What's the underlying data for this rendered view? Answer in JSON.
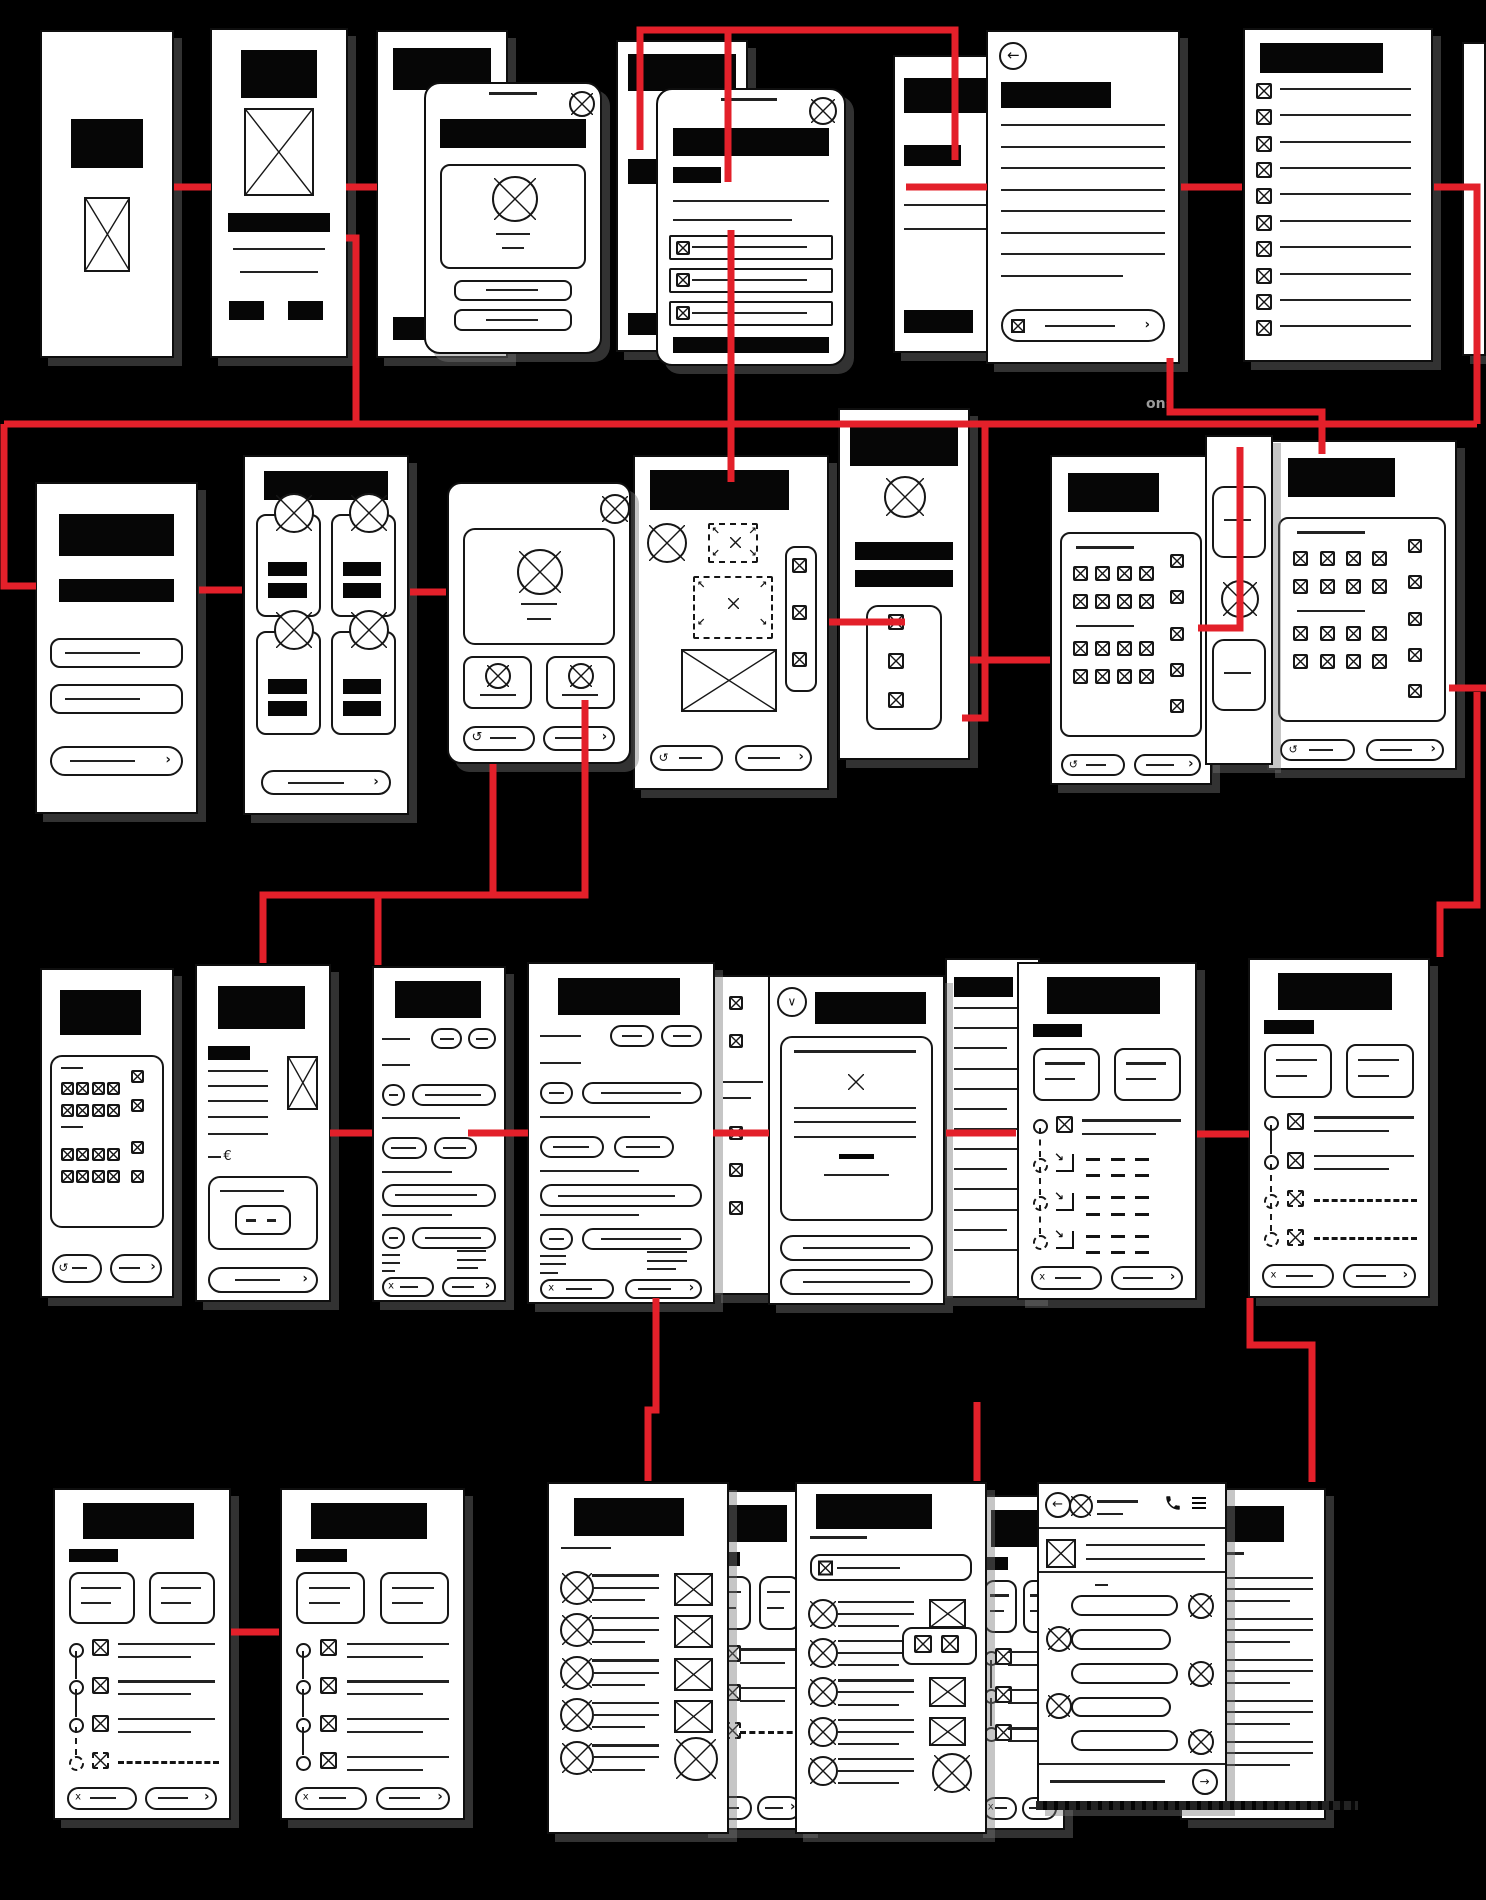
{
  "canvas": {
    "width": 1486,
    "height": 1900,
    "background": "#000000"
  },
  "palette": {
    "screen_bg": "#ffffff",
    "ink": "#161616",
    "black_fill": "#060606",
    "connector_red": "#e3202a",
    "shadow_gray": "rgba(118,118,118,0.42)"
  },
  "icons": {
    "back": "←",
    "send": "→",
    "chevron_right": "›",
    "chevron_down": "∨",
    "undo": "↺",
    "cancel_x": "x",
    "euro": "€",
    "redirect": "↘",
    "corner_arrows": [
      "↖",
      "↗",
      "↙",
      "↘"
    ]
  },
  "captions": [
    {
      "id": "caption-fragment-ons",
      "text": "ons",
      "x": 1146,
      "y": 396,
      "color": "#9b9b9b",
      "size": 14
    },
    {
      "id": "caption-illegible-chat",
      "text": "",
      "x": 1036,
      "y": 1801,
      "w": 322,
      "h": 9
    }
  ],
  "screens": [
    {
      "id": "splash",
      "name": "screen-splash",
      "kind": "hero",
      "x": 40,
      "y": 30,
      "w": 134,
      "h": 328,
      "z": 2
    },
    {
      "id": "onboarding",
      "name": "screen-onboarding",
      "kind": "onboard",
      "x": 210,
      "y": 28,
      "w": 138,
      "h": 330,
      "z": 2
    },
    {
      "id": "welcome-base",
      "name": "screen-welcome-base",
      "kind": "cover",
      "x": 376,
      "y": 30,
      "w": 132,
      "h": 328,
      "z": 2
    },
    {
      "id": "profile-modal",
      "name": "modal-profile-setup",
      "kind": "modalProfile",
      "x": 424,
      "y": 82,
      "w": 178,
      "h": 272,
      "z": 3,
      "r": 16
    },
    {
      "id": "content-base",
      "name": "screen-content-base",
      "kind": "cover2",
      "x": 616,
      "y": 40,
      "w": 132,
      "h": 312,
      "z": 2
    },
    {
      "id": "options-modal",
      "name": "modal-options-list",
      "kind": "modalList",
      "x": 656,
      "y": 88,
      "w": 190,
      "h": 278,
      "z": 4,
      "r": 16
    },
    {
      "id": "detail-underlay",
      "name": "screen-detail-underlay",
      "kind": "underlay",
      "x": 893,
      "y": 55,
      "w": 118,
      "h": 298,
      "z": 2
    },
    {
      "id": "article-back",
      "name": "screen-article-detail",
      "kind": "back",
      "x": 986,
      "y": 30,
      "w": 194,
      "h": 334,
      "z": 3
    },
    {
      "id": "checklist",
      "name": "screen-checklist",
      "kind": "checklist",
      "x": 1243,
      "y": 28,
      "w": 190,
      "h": 334,
      "z": 2
    },
    {
      "id": "edge-sliver",
      "name": "screen-edge-sliver",
      "kind": "sliver",
      "x": 1462,
      "y": 42,
      "w": 24,
      "h": 314,
      "z": 1
    },
    {
      "id": "login",
      "name": "screen-login",
      "kind": "login",
      "x": 35,
      "y": 482,
      "w": 163,
      "h": 332,
      "z": 2
    },
    {
      "id": "catalog",
      "name": "screen-catalog",
      "kind": "catalog",
      "x": 243,
      "y": 455,
      "w": 166,
      "h": 360,
      "z": 2
    },
    {
      "id": "item-modal",
      "name": "modal-item-preview",
      "kind": "itemModal",
      "x": 447,
      "y": 482,
      "w": 184,
      "h": 282,
      "z": 3,
      "r": 14
    },
    {
      "id": "upload",
      "name": "screen-upload",
      "kind": "upload",
      "x": 633,
      "y": 455,
      "w": 196,
      "h": 335,
      "z": 2
    },
    {
      "id": "profile-strip",
      "name": "screen-profile-strip",
      "kind": "stripNarrow",
      "x": 838,
      "y": 408,
      "w": 132,
      "h": 352,
      "z": 2
    },
    {
      "id": "icon-grid-a",
      "name": "screen-icon-grid-a",
      "kind": "iconGrid",
      "x": 1050,
      "y": 455,
      "w": 162,
      "h": 330,
      "z": 2
    },
    {
      "id": "mini-strip",
      "name": "screen-mini-strip",
      "kind": "miniStrip",
      "x": 1205,
      "y": 435,
      "w": 68,
      "h": 330,
      "z": 3
    },
    {
      "id": "icon-grid-b",
      "name": "screen-icon-grid-b",
      "kind": "iconGrid",
      "x": 1267,
      "y": 440,
      "w": 190,
      "h": 330,
      "z": 2
    },
    {
      "id": "grid-small",
      "name": "screen-icon-grid-small",
      "kind": "gridSmall",
      "x": 40,
      "y": 968,
      "w": 134,
      "h": 330,
      "z": 2
    },
    {
      "id": "invoice",
      "name": "screen-invoice",
      "kind": "invoice",
      "x": 195,
      "y": 964,
      "w": 136,
      "h": 338,
      "z": 2
    },
    {
      "id": "form-a",
      "name": "screen-form-a",
      "kind": "form",
      "x": 372,
      "y": 966,
      "w": 134,
      "h": 336,
      "z": 2
    },
    {
      "id": "form-b",
      "name": "screen-form-b",
      "kind": "form",
      "x": 527,
      "y": 962,
      "w": 188,
      "h": 342,
      "z": 3
    },
    {
      "id": "grid-sliver",
      "name": "screen-grid-sliver",
      "kind": "gridBehind",
      "x": 713,
      "y": 975,
      "w": 60,
      "h": 320,
      "z": 2
    },
    {
      "id": "confirm-card",
      "name": "screen-confirm-card",
      "kind": "confirm",
      "x": 768,
      "y": 975,
      "w": 177,
      "h": 330,
      "z": 3
    },
    {
      "id": "lines-sliver",
      "name": "screen-lines-sliver",
      "kind": "linesSliver",
      "x": 945,
      "y": 958,
      "w": 95,
      "h": 340,
      "z": 2
    },
    {
      "id": "stepper-a",
      "name": "screen-stepper-a",
      "kind": "stepper",
      "x": 1017,
      "y": 962,
      "w": 180,
      "h": 338,
      "z": 3,
      "rows": [
        "x",
        "arrow",
        "arrow",
        "arrow"
      ]
    },
    {
      "id": "stepper-b",
      "name": "screen-stepper-b",
      "kind": "stepper",
      "x": 1248,
      "y": 958,
      "w": 182,
      "h": 340,
      "z": 2,
      "rows": [
        "x",
        "x",
        "dashed",
        "dashed"
      ]
    },
    {
      "id": "stepper-c",
      "name": "screen-stepper-c",
      "kind": "stepper",
      "x": 53,
      "y": 1488,
      "w": 178,
      "h": 332,
      "z": 2,
      "rows": [
        "x",
        "x",
        "x",
        "dashed"
      ]
    },
    {
      "id": "stepper-d",
      "name": "screen-stepper-d",
      "kind": "stepper",
      "x": 280,
      "y": 1488,
      "w": 185,
      "h": 332,
      "z": 2,
      "rows": [
        "x",
        "x",
        "x",
        "x"
      ]
    },
    {
      "id": "contacts",
      "name": "screen-contacts-list",
      "kind": "contacts",
      "x": 547,
      "y": 1482,
      "w": 182,
      "h": 352,
      "z": 4
    },
    {
      "id": "stepper-e",
      "name": "screen-stepper-sliver-a",
      "kind": "stepper",
      "x": 700,
      "y": 1490,
      "w": 110,
      "h": 340,
      "z": 3,
      "rows": [
        "x",
        "x",
        "dashed"
      ]
    },
    {
      "id": "search",
      "name": "screen-search-results",
      "kind": "search",
      "x": 795,
      "y": 1482,
      "w": 192,
      "h": 352,
      "z": 4
    },
    {
      "id": "stepper-f",
      "name": "screen-stepper-sliver-b",
      "kind": "stepper",
      "x": 975,
      "y": 1495,
      "w": 90,
      "h": 335,
      "z": 3,
      "rows": [
        "x",
        "x",
        "x"
      ]
    },
    {
      "id": "chat",
      "name": "screen-chat",
      "kind": "chat",
      "x": 1037,
      "y": 1482,
      "w": 190,
      "h": 326,
      "z": 5
    },
    {
      "id": "feed",
      "name": "screen-feed",
      "kind": "feedBehind",
      "x": 1180,
      "y": 1488,
      "w": 146,
      "h": 332,
      "z": 4
    }
  ],
  "connectors": [
    {
      "id": "c1",
      "points": [
        [
          174,
          187
        ],
        [
          211,
          187
        ]
      ]
    },
    {
      "id": "c2",
      "points": [
        [
          346,
          187
        ],
        [
          377,
          187
        ]
      ]
    },
    {
      "id": "c3",
      "points": [
        [
          640,
          150
        ],
        [
          640,
          30
        ],
        [
          955,
          30
        ],
        [
          955,
          160
        ]
      ]
    },
    {
      "id": "c4",
      "points": [
        [
          728,
          30
        ],
        [
          728,
          182
        ]
      ]
    },
    {
      "id": "c5",
      "points": [
        [
          906,
          187
        ],
        [
          987,
          187
        ]
      ]
    },
    {
      "id": "c6",
      "points": [
        [
          1181,
          187
        ],
        [
          1242,
          187
        ]
      ]
    },
    {
      "id": "c7",
      "points": [
        [
          1434,
          187
        ],
        [
          1477,
          187
        ],
        [
          1477,
          424
        ]
      ]
    },
    {
      "id": "c8",
      "points": [
        [
          4,
          424
        ],
        [
          1477,
          424
        ]
      ]
    },
    {
      "id": "c9",
      "points": [
        [
          4,
          424
        ],
        [
          4,
          586
        ],
        [
          36,
          586
        ]
      ]
    },
    {
      "id": "c10",
      "points": [
        [
          346,
          238
        ],
        [
          356,
          238
        ],
        [
          356,
          424
        ]
      ]
    },
    {
      "id": "c11",
      "points": [
        [
          731,
          230
        ],
        [
          731,
          482
        ]
      ]
    },
    {
      "id": "c12",
      "points": [
        [
          1170,
          358
        ],
        [
          1170,
          412
        ],
        [
          1322,
          412
        ],
        [
          1322,
          454
        ]
      ]
    },
    {
      "id": "c13",
      "points": [
        [
          199,
          590
        ],
        [
          242,
          590
        ]
      ]
    },
    {
      "id": "c14",
      "points": [
        [
          410,
          592
        ],
        [
          446,
          592
        ]
      ]
    },
    {
      "id": "c15",
      "points": [
        [
          829,
          622
        ],
        [
          905,
          622
        ]
      ]
    },
    {
      "id": "c16",
      "points": [
        [
          985,
          424
        ],
        [
          985,
          718
        ],
        [
          962,
          718
        ]
      ]
    },
    {
      "id": "c17",
      "points": [
        [
          970,
          660
        ],
        [
          1050,
          660
        ]
      ]
    },
    {
      "id": "c18",
      "points": [
        [
          1240,
          447
        ],
        [
          1240,
          628
        ],
        [
          1198,
          628
        ]
      ]
    },
    {
      "id": "c19",
      "points": [
        [
          1449,
          688
        ],
        [
          1486,
          688
        ]
      ]
    },
    {
      "id": "c20",
      "points": [
        [
          585,
          700
        ],
        [
          585,
          895
        ],
        [
          263,
          895
        ],
        [
          263,
          963
        ]
      ]
    },
    {
      "id": "c21",
      "points": [
        [
          493,
          764
        ],
        [
          493,
          895
        ],
        [
          378,
          895
        ],
        [
          378,
          965
        ]
      ]
    },
    {
      "id": "c22",
      "points": [
        [
          330,
          1133
        ],
        [
          372,
          1133
        ]
      ]
    },
    {
      "id": "c23",
      "points": [
        [
          468,
          1133
        ],
        [
          528,
          1133
        ]
      ]
    },
    {
      "id": "c24",
      "points": [
        [
          713,
          1133
        ],
        [
          769,
          1133
        ]
      ]
    },
    {
      "id": "c25",
      "points": [
        [
          946,
          1133
        ],
        [
          1016,
          1133
        ]
      ]
    },
    {
      "id": "c26",
      "points": [
        [
          1197,
          1134
        ],
        [
          1249,
          1134
        ]
      ]
    },
    {
      "id": "c27",
      "points": [
        [
          1477,
          692
        ],
        [
          1477,
          905
        ],
        [
          1440,
          905
        ],
        [
          1440,
          957
        ]
      ]
    },
    {
      "id": "c28",
      "points": [
        [
          1250,
          1298
        ],
        [
          1250,
          1345
        ],
        [
          1312,
          1345
        ],
        [
          1312,
          1482
        ]
      ]
    },
    {
      "id": "c29",
      "points": [
        [
          656,
          1298
        ],
        [
          656,
          1410
        ],
        [
          648,
          1410
        ],
        [
          648,
          1481
        ]
      ]
    },
    {
      "id": "c30",
      "points": [
        [
          977,
          1402
        ],
        [
          977,
          1481
        ]
      ]
    },
    {
      "id": "c31",
      "points": [
        [
          231,
          1632
        ],
        [
          279,
          1632
        ]
      ]
    }
  ]
}
